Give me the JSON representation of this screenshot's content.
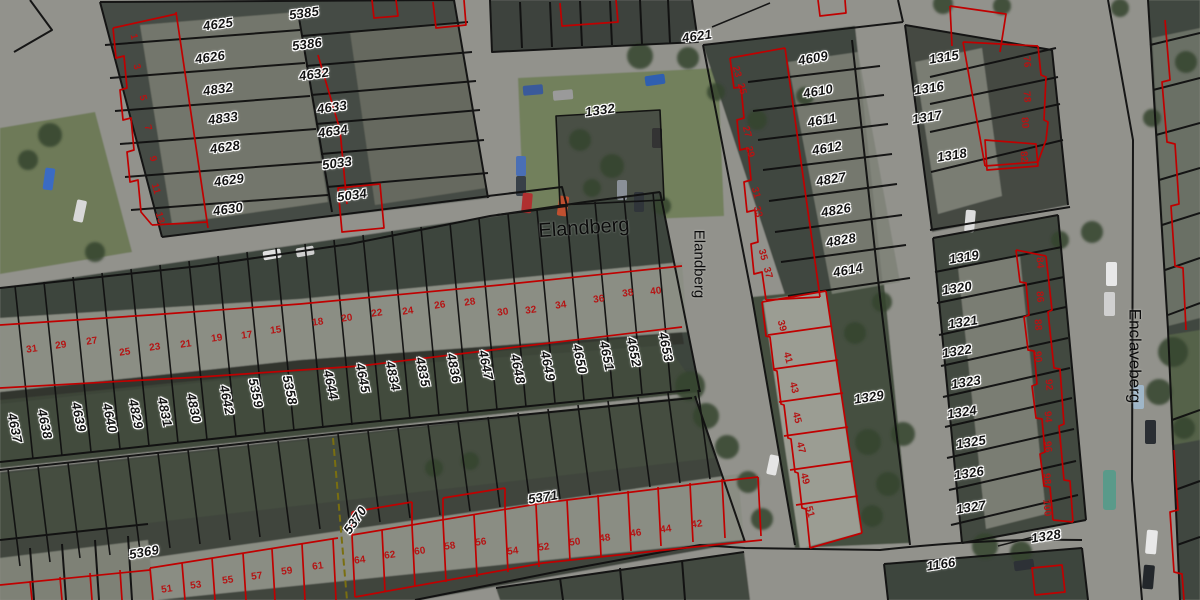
{
  "map": {
    "colors": {
      "cadastral_line": "#101010",
      "unit_line": "#c00000",
      "parcel_label": "#131313",
      "house_number": "#b51414",
      "label_halo": "#ffffff"
    },
    "labels": {
      "streets": [
        {
          "t": "Elandberg",
          "x": 584,
          "y": 228,
          "r": -4,
          "s": 20
        },
        {
          "t": "Elandberg",
          "x": 699,
          "y": 264,
          "r": 90,
          "s": 15
        },
        {
          "t": "Enclaveberg",
          "x": 1135,
          "y": 356,
          "r": 90,
          "s": 17
        }
      ],
      "parcels": [
        {
          "t": "4625",
          "x": 218,
          "y": 24,
          "r": -8
        },
        {
          "t": "5385",
          "x": 304,
          "y": 13,
          "r": -8
        },
        {
          "t": "4626",
          "x": 210,
          "y": 57,
          "r": -8
        },
        {
          "t": "5386",
          "x": 307,
          "y": 44,
          "r": -8
        },
        {
          "t": "4832",
          "x": 218,
          "y": 89,
          "r": -8
        },
        {
          "t": "4632",
          "x": 314,
          "y": 74,
          "r": -8
        },
        {
          "t": "4833",
          "x": 223,
          "y": 118,
          "r": -8
        },
        {
          "t": "4633",
          "x": 332,
          "y": 107,
          "r": -8
        },
        {
          "t": "4628",
          "x": 225,
          "y": 147,
          "r": -8
        },
        {
          "t": "4634",
          "x": 333,
          "y": 131,
          "r": -8
        },
        {
          "t": "4629",
          "x": 229,
          "y": 180,
          "r": -8
        },
        {
          "t": "5033",
          "x": 337,
          "y": 163,
          "r": -8
        },
        {
          "t": "4630",
          "x": 228,
          "y": 209,
          "r": -8
        },
        {
          "t": "5034",
          "x": 352,
          "y": 195,
          "r": -8
        },
        {
          "t": "4621",
          "x": 697,
          "y": 36,
          "r": -8
        },
        {
          "t": "1332",
          "x": 600,
          "y": 110,
          "r": -8
        },
        {
          "t": "4609",
          "x": 813,
          "y": 58,
          "r": -10
        },
        {
          "t": "4610",
          "x": 818,
          "y": 91,
          "r": -10
        },
        {
          "t": "4611",
          "x": 822,
          "y": 120,
          "r": -10
        },
        {
          "t": "4612",
          "x": 827,
          "y": 148,
          "r": -10
        },
        {
          "t": "4827",
          "x": 831,
          "y": 179,
          "r": -10
        },
        {
          "t": "4826",
          "x": 836,
          "y": 210,
          "r": -10
        },
        {
          "t": "4828",
          "x": 841,
          "y": 240,
          "r": -10
        },
        {
          "t": "4614",
          "x": 848,
          "y": 270,
          "r": -10
        },
        {
          "t": "1315",
          "x": 944,
          "y": 57,
          "r": -9
        },
        {
          "t": "1316",
          "x": 929,
          "y": 88,
          "r": -9
        },
        {
          "t": "1317",
          "x": 927,
          "y": 117,
          "r": -9
        },
        {
          "t": "1318",
          "x": 952,
          "y": 155,
          "r": -9
        },
        {
          "t": "1319",
          "x": 964,
          "y": 257,
          "r": -9
        },
        {
          "t": "1320",
          "x": 957,
          "y": 288,
          "r": -9
        },
        {
          "t": "1321",
          "x": 963,
          "y": 322,
          "r": -9
        },
        {
          "t": "1322",
          "x": 957,
          "y": 351,
          "r": -9
        },
        {
          "t": "1323",
          "x": 966,
          "y": 382,
          "r": -9
        },
        {
          "t": "1324",
          "x": 962,
          "y": 412,
          "r": -9
        },
        {
          "t": "1325",
          "x": 971,
          "y": 442,
          "r": -9
        },
        {
          "t": "1326",
          "x": 969,
          "y": 473,
          "r": -9
        },
        {
          "t": "1327",
          "x": 971,
          "y": 507,
          "r": -9
        },
        {
          "t": "1328",
          "x": 1046,
          "y": 536,
          "r": -9
        },
        {
          "t": "1166",
          "x": 941,
          "y": 564,
          "r": -9
        },
        {
          "t": "1329",
          "x": 869,
          "y": 397,
          "r": -9
        },
        {
          "t": "5369",
          "x": 144,
          "y": 552,
          "r": -10
        },
        {
          "t": "5370",
          "x": 355,
          "y": 520,
          "r": -55
        },
        {
          "t": "5371",
          "x": 543,
          "y": 497,
          "r": -9
        },
        {
          "t": "4637",
          "x": 15,
          "y": 428,
          "r": 78
        },
        {
          "t": "4638",
          "x": 45,
          "y": 424,
          "r": 78
        },
        {
          "t": "4639",
          "x": 79,
          "y": 417,
          "r": 78
        },
        {
          "t": "4640",
          "x": 110,
          "y": 418,
          "r": 78
        },
        {
          "t": "4829",
          "x": 136,
          "y": 414,
          "r": 78
        },
        {
          "t": "4831",
          "x": 165,
          "y": 412,
          "r": 78
        },
        {
          "t": "4830",
          "x": 194,
          "y": 408,
          "r": 78
        },
        {
          "t": "4642",
          "x": 227,
          "y": 400,
          "r": 78
        },
        {
          "t": "5359",
          "x": 256,
          "y": 393,
          "r": 78
        },
        {
          "t": "5358",
          "x": 290,
          "y": 390,
          "r": 78
        },
        {
          "t": "4644",
          "x": 331,
          "y": 385,
          "r": 78
        },
        {
          "t": "4645",
          "x": 363,
          "y": 378,
          "r": 78
        },
        {
          "t": "4834",
          "x": 393,
          "y": 376,
          "r": 78
        },
        {
          "t": "4835",
          "x": 423,
          "y": 372,
          "r": 78
        },
        {
          "t": "4836",
          "x": 454,
          "y": 368,
          "r": 78
        },
        {
          "t": "4647",
          "x": 486,
          "y": 365,
          "r": 78
        },
        {
          "t": "4648",
          "x": 518,
          "y": 369,
          "r": 78
        },
        {
          "t": "4649",
          "x": 548,
          "y": 366,
          "r": 78
        },
        {
          "t": "4650",
          "x": 580,
          "y": 359,
          "r": 78
        },
        {
          "t": "4651",
          "x": 607,
          "y": 356,
          "r": 78
        },
        {
          "t": "4652",
          "x": 634,
          "y": 352,
          "r": 78
        },
        {
          "t": "4653",
          "x": 666,
          "y": 347,
          "r": 78
        }
      ],
      "house_numbers": [
        {
          "t": "31",
          "x": 32,
          "y": 350,
          "r": -8
        },
        {
          "t": "29",
          "x": 61,
          "y": 346,
          "r": -8
        },
        {
          "t": "27",
          "x": 92,
          "y": 342,
          "r": -8
        },
        {
          "t": "25",
          "x": 125,
          "y": 353,
          "r": -8
        },
        {
          "t": "23",
          "x": 155,
          "y": 348,
          "r": -8
        },
        {
          "t": "21",
          "x": 186,
          "y": 345,
          "r": -8
        },
        {
          "t": "19",
          "x": 217,
          "y": 339,
          "r": -8
        },
        {
          "t": "17",
          "x": 247,
          "y": 336,
          "r": -8
        },
        {
          "t": "15",
          "x": 276,
          "y": 331,
          "r": -8
        },
        {
          "t": "18",
          "x": 318,
          "y": 323,
          "r": -8
        },
        {
          "t": "20",
          "x": 347,
          "y": 319,
          "r": -8
        },
        {
          "t": "22",
          "x": 377,
          "y": 314,
          "r": -8
        },
        {
          "t": "24",
          "x": 408,
          "y": 312,
          "r": -8
        },
        {
          "t": "26",
          "x": 440,
          "y": 306,
          "r": -8
        },
        {
          "t": "28",
          "x": 470,
          "y": 303,
          "r": -8
        },
        {
          "t": "30",
          "x": 503,
          "y": 313,
          "r": -8
        },
        {
          "t": "32",
          "x": 531,
          "y": 311,
          "r": -8
        },
        {
          "t": "34",
          "x": 561,
          "y": 306,
          "r": -8
        },
        {
          "t": "36",
          "x": 599,
          "y": 300,
          "r": -8
        },
        {
          "t": "38",
          "x": 628,
          "y": 294,
          "r": -8
        },
        {
          "t": "40",
          "x": 656,
          "y": 292,
          "r": -8
        },
        {
          "t": "1",
          "x": 133,
          "y": 37,
          "r": 75
        },
        {
          "t": "3",
          "x": 136,
          "y": 67,
          "r": 75
        },
        {
          "t": "5",
          "x": 142,
          "y": 98,
          "r": 75
        },
        {
          "t": "7",
          "x": 147,
          "y": 128,
          "r": 75
        },
        {
          "t": "9",
          "x": 152,
          "y": 159,
          "r": 75
        },
        {
          "t": "11",
          "x": 155,
          "y": 189,
          "r": 75
        },
        {
          "t": "13",
          "x": 159,
          "y": 218,
          "r": 75
        },
        {
          "t": "23",
          "x": 736,
          "y": 72,
          "r": 75
        },
        {
          "t": "25",
          "x": 741,
          "y": 89,
          "r": 75
        },
        {
          "t": "27",
          "x": 746,
          "y": 132,
          "r": 75
        },
        {
          "t": "29",
          "x": 749,
          "y": 152,
          "r": 75
        },
        {
          "t": "31",
          "x": 755,
          "y": 193,
          "r": 75
        },
        {
          "t": "33",
          "x": 757,
          "y": 212,
          "r": 75
        },
        {
          "t": "35",
          "x": 762,
          "y": 255,
          "r": 75
        },
        {
          "t": "37",
          "x": 767,
          "y": 273,
          "r": 75
        },
        {
          "t": "39",
          "x": 781,
          "y": 326,
          "r": 75
        },
        {
          "t": "41",
          "x": 787,
          "y": 358,
          "r": 75
        },
        {
          "t": "43",
          "x": 793,
          "y": 388,
          "r": 75
        },
        {
          "t": "45",
          "x": 796,
          "y": 418,
          "r": 75
        },
        {
          "t": "47",
          "x": 800,
          "y": 448,
          "r": 75
        },
        {
          "t": "49",
          "x": 804,
          "y": 479,
          "r": 75
        },
        {
          "t": "51",
          "x": 809,
          "y": 512,
          "r": 75
        },
        {
          "t": "51",
          "x": 167,
          "y": 590,
          "r": -8
        },
        {
          "t": "53",
          "x": 196,
          "y": 586,
          "r": -8
        },
        {
          "t": "55",
          "x": 228,
          "y": 581,
          "r": -8
        },
        {
          "t": "57",
          "x": 257,
          "y": 577,
          "r": -8
        },
        {
          "t": "59",
          "x": 287,
          "y": 572,
          "r": -8
        },
        {
          "t": "61",
          "x": 318,
          "y": 567,
          "r": -8
        },
        {
          "t": "64",
          "x": 360,
          "y": 561,
          "r": -8
        },
        {
          "t": "62",
          "x": 390,
          "y": 556,
          "r": -8
        },
        {
          "t": "60",
          "x": 420,
          "y": 552,
          "r": -8
        },
        {
          "t": "58",
          "x": 450,
          "y": 547,
          "r": -8
        },
        {
          "t": "56",
          "x": 481,
          "y": 543,
          "r": -8
        },
        {
          "t": "54",
          "x": 513,
          "y": 552,
          "r": -8
        },
        {
          "t": "52",
          "x": 544,
          "y": 548,
          "r": -8
        },
        {
          "t": "50",
          "x": 575,
          "y": 543,
          "r": -8
        },
        {
          "t": "48",
          "x": 605,
          "y": 539,
          "r": -8
        },
        {
          "t": "46",
          "x": 636,
          "y": 534,
          "r": -8
        },
        {
          "t": "44",
          "x": 666,
          "y": 530,
          "r": -8
        },
        {
          "t": "42",
          "x": 697,
          "y": 525,
          "r": -8
        },
        {
          "t": "76",
          "x": 1026,
          "y": 62,
          "r": 85
        },
        {
          "t": "78",
          "x": 1026,
          "y": 97,
          "r": 85
        },
        {
          "t": "80",
          "x": 1024,
          "y": 123,
          "r": 85
        },
        {
          "t": "82",
          "x": 1023,
          "y": 157,
          "r": 85
        },
        {
          "t": "84",
          "x": 1039,
          "y": 263,
          "r": 85
        },
        {
          "t": "86",
          "x": 1039,
          "y": 297,
          "r": 85
        },
        {
          "t": "88",
          "x": 1037,
          "y": 325,
          "r": 85
        },
        {
          "t": "90",
          "x": 1037,
          "y": 357,
          "r": 85
        },
        {
          "t": "92",
          "x": 1048,
          "y": 385,
          "r": 85
        },
        {
          "t": "94",
          "x": 1047,
          "y": 417,
          "r": 85
        },
        {
          "t": "96",
          "x": 1047,
          "y": 447,
          "r": 85
        },
        {
          "t": "98",
          "x": 1046,
          "y": 479,
          "r": 85
        },
        {
          "t": "100",
          "x": 1046,
          "y": 508,
          "r": 85
        }
      ]
    }
  }
}
